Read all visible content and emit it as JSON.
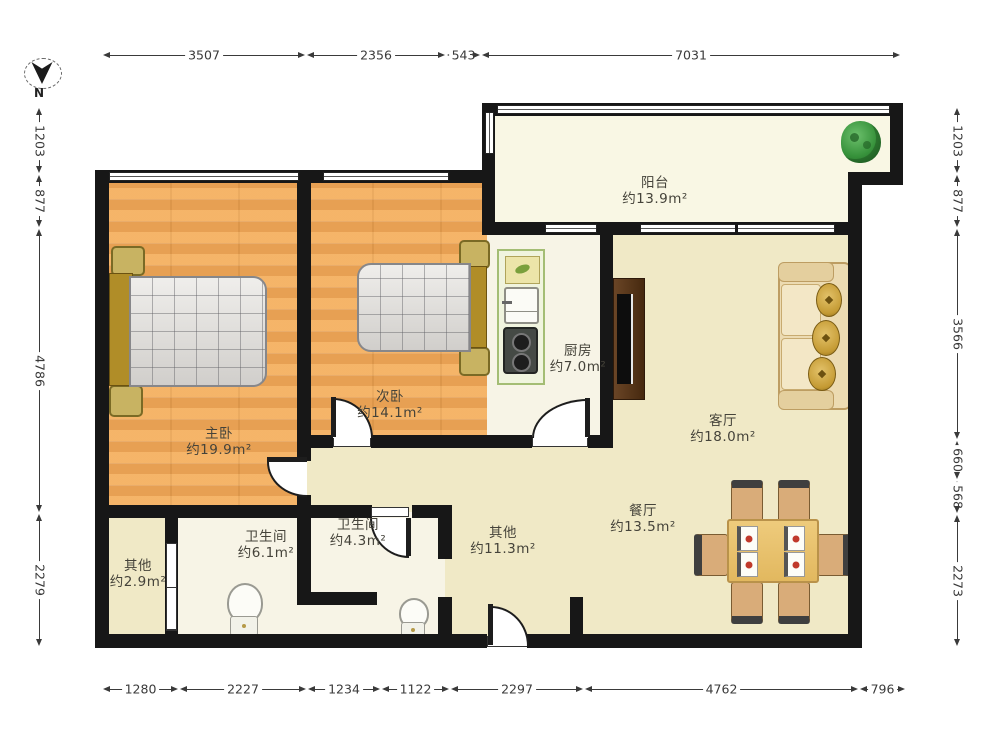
{
  "compass": {
    "north_label": "N"
  },
  "rooms": {
    "balcony": {
      "name": "阳台",
      "area": "约13.9m²"
    },
    "kitchen": {
      "name": "厨房",
      "area": "约7.0m²"
    },
    "living_room": {
      "name": "客厅",
      "area": "约18.0m²"
    },
    "dining_room": {
      "name": "餐厅",
      "area": "约13.5m²"
    },
    "hallway": {
      "name": "其他",
      "area": "约11.3m²"
    },
    "master_bedroom": {
      "name": "主卧",
      "area": "约19.9m²"
    },
    "second_bedroom": {
      "name": "次卧",
      "area": "约14.1m²"
    },
    "bathroom_large": {
      "name": "卫生间",
      "area": "约6.1m²"
    },
    "bathroom_small": {
      "name": "卫生间",
      "area": "约4.3m²"
    },
    "storage": {
      "name": "其他",
      "area": "约2.9m²"
    }
  },
  "dimensions_mm": {
    "top": [
      "3507",
      "2356",
      "543",
      "7031"
    ],
    "bottom": [
      "1280",
      "2227",
      "1234",
      "1122",
      "2297",
      "4762",
      "796"
    ],
    "left": [
      "1203",
      "877",
      "4786",
      "2279"
    ],
    "right": [
      "1203",
      "877",
      "3566",
      "660",
      "568",
      "2273"
    ]
  },
  "colors": {
    "wall": "#171717",
    "wood_floor": "#f1ae62",
    "tan_floor": "#f0e9c6",
    "balcony_floor": "#f9f7e4",
    "counter_green": "#a4bd74",
    "plant_green": "#37923b",
    "pillow_gold": "#c49a33"
  }
}
